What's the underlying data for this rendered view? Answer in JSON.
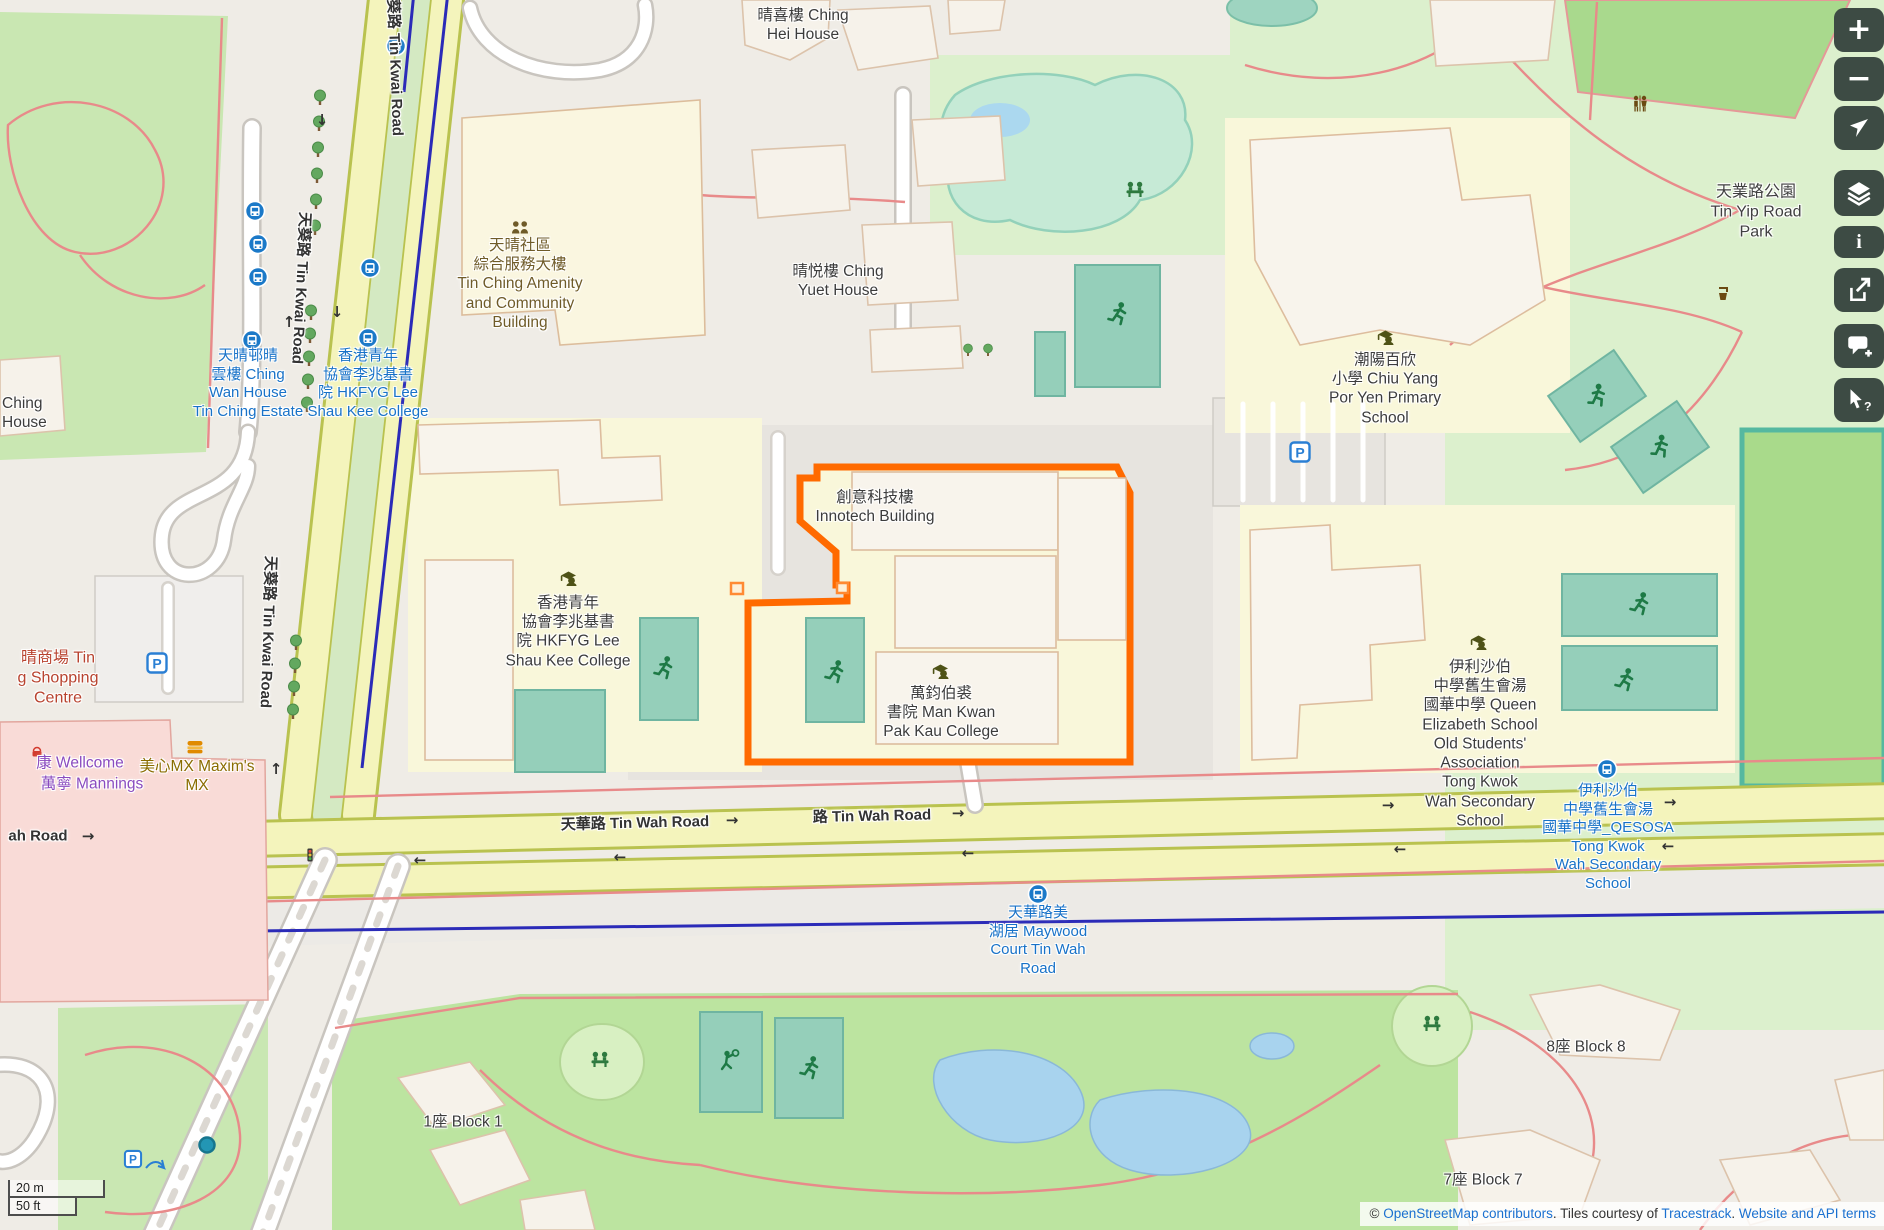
{
  "labels": {
    "ching_hei": "晴喜樓 Ching\nHei House",
    "tin_kwai_road": "天葵路 Tin Kwai Road",
    "amenity": "天晴社區\n綜合服務大樓\nTin Ching Amenity\nand Community\nBuilding",
    "ching_yuet": "晴悦樓 Ching\nYuet House",
    "chiu_yang": "潮陽百欣\n小學 Chiu Yang\nPor Yen Primary\nSchool",
    "tin_yip_park": "天業路公園\nTin Yip Road\nPark",
    "stop_ching_wan": "天晴邨晴\n雲樓 Ching\nWan House\nTin Ching Estate",
    "stop_hkfyg": "香港青年\n協會李兆基書\n院 HKFYG Lee\nShau Kee College",
    "ching_house": "Ching\nHouse",
    "hkfyg_college": "香港青年\n協會李兆基書\n院 HKFYG Lee\nShau Kee College",
    "innotech": "創意科技樓\nInnotech Building",
    "man_kwan": "萬鈞伯裘\n書院 Man Kwan\nPak Kau College",
    "qes_school": "伊利沙伯\n中學舊生會湯\n國華中學 Queen\nElizabeth School\nOld Students'\nAssociation\nTong Kwok\nWah Secondary\nSchool",
    "stop_qesosa": "伊利沙伯\n中學舊生會湯\n國華中學_QESOSA\nTong Kwok\nWah Secondary\nSchool",
    "tin_wah_road_w": "天華路 Tin Wah Road",
    "tin_wah_road_e": "路 Tin Wah Road",
    "ah_road": "ah Road",
    "stop_maywood": "天華路美\n湖居 Maywood\nCourt Tin Wah\nRoad",
    "block_1": "1座 Block 1",
    "block_8": "8座 Block 8",
    "block_7": "7座 Block 7",
    "mall": "晴商場 Tin\ng Shopping\nCentre",
    "wellcome": "康 Wellcome",
    "mannings": "萬寧 Mannings",
    "maxims": "美心MX Maxim's\nMX"
  },
  "glyphs": {
    "arrow_right": "→",
    "arrow_left": "←",
    "arrow_up": "↑",
    "arrow_down": "↓",
    "parking": "P",
    "plus": "+",
    "minus": "−",
    "info": "i",
    "query": "?"
  },
  "scalebar": {
    "metric": "20 m",
    "imperial": "50 ft"
  },
  "attribution": {
    "prefix": "© ",
    "osm_link": "OpenStreetMap contributors",
    "middle": ". Tiles courtesy of ",
    "tracestrack_link": "Tracestrack",
    "separator": ". ",
    "terms_link": "Website and API terms"
  },
  "colors": {
    "highlight_orange": "#ff6a00",
    "transit_blue": "#1b79c8",
    "control_bg": "#3d4b44",
    "road_yellow": "#f4f4bc",
    "pitch_teal": "#95cfba"
  }
}
